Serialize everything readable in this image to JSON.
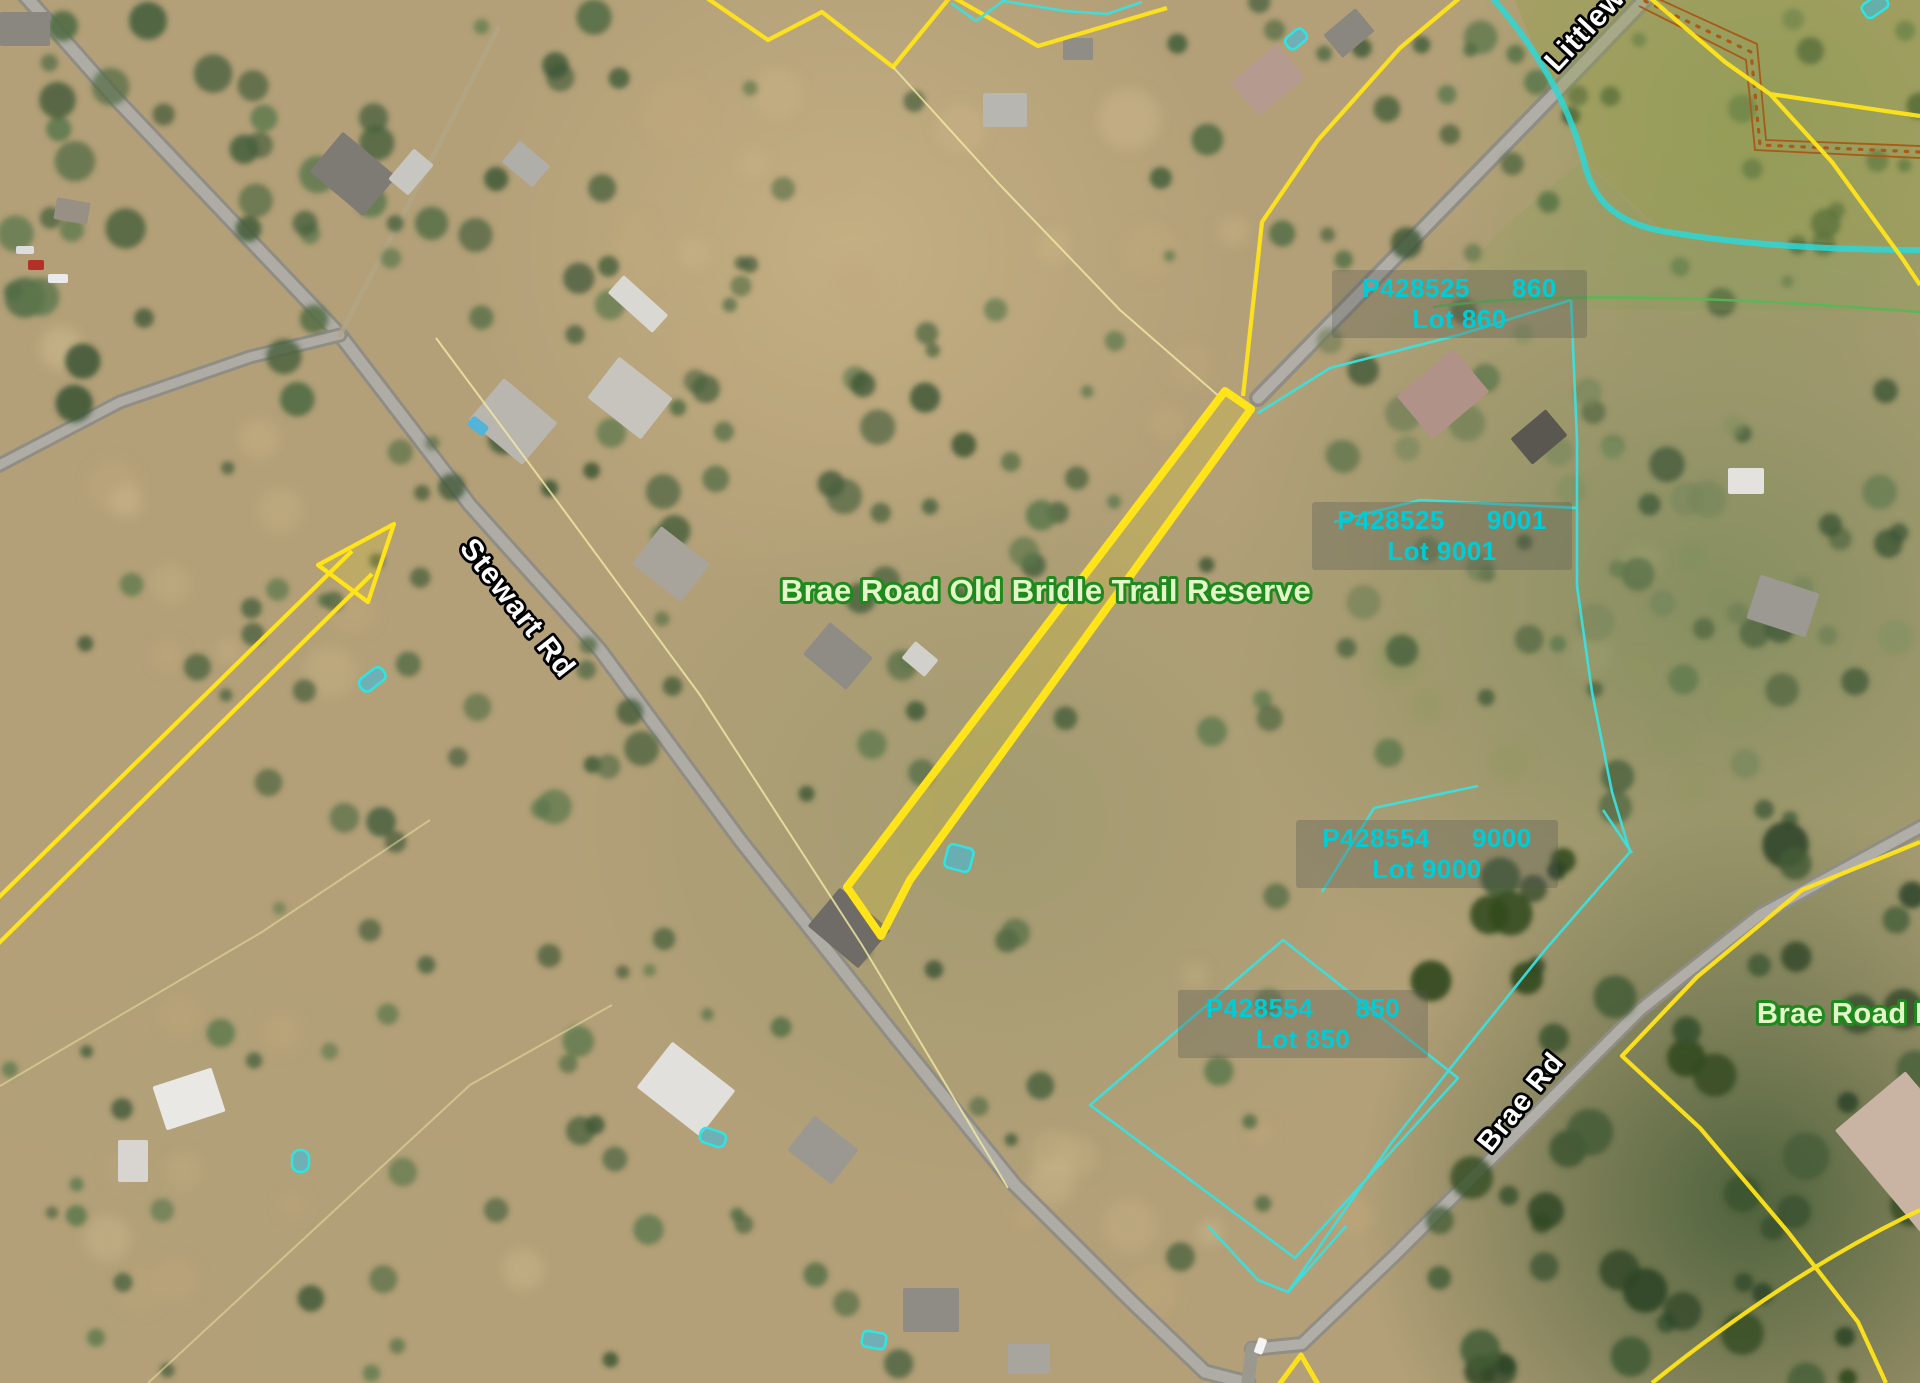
{
  "map": {
    "colors": {
      "selection_yellow": "#ffe41a",
      "cadastre_cyan": "#3be0df",
      "lot_text_cyan": "#00ccd6",
      "reserve_text_fill": "#e4f6c8",
      "reserve_text_outline": "#1e8a1e",
      "road_text_fill": "#ffffff",
      "road_text_outline": "#000000",
      "track_orange": "#a85a18",
      "water_teal": "#2cd8d8",
      "boundary_green": "#55b855"
    },
    "labels": {
      "road_stewart": "Stewart Rd",
      "road_brae": "Brae Rd",
      "road_littlewood_partial": "Littlew",
      "reserve_main": "Brae Road Old Bridle Trail Reserve",
      "reserve_right_partial": "Brae Road R"
    },
    "parcels": [
      {
        "plan": "P428525",
        "number": "860",
        "lot": "Lot 860"
      },
      {
        "plan": "P428525",
        "number": "9001",
        "lot": "Lot 9001"
      },
      {
        "plan": "P428554",
        "number": "9000",
        "lot": "Lot 9000"
      },
      {
        "plan": "P428554",
        "number": "850",
        "lot": "Lot 850"
      }
    ]
  }
}
